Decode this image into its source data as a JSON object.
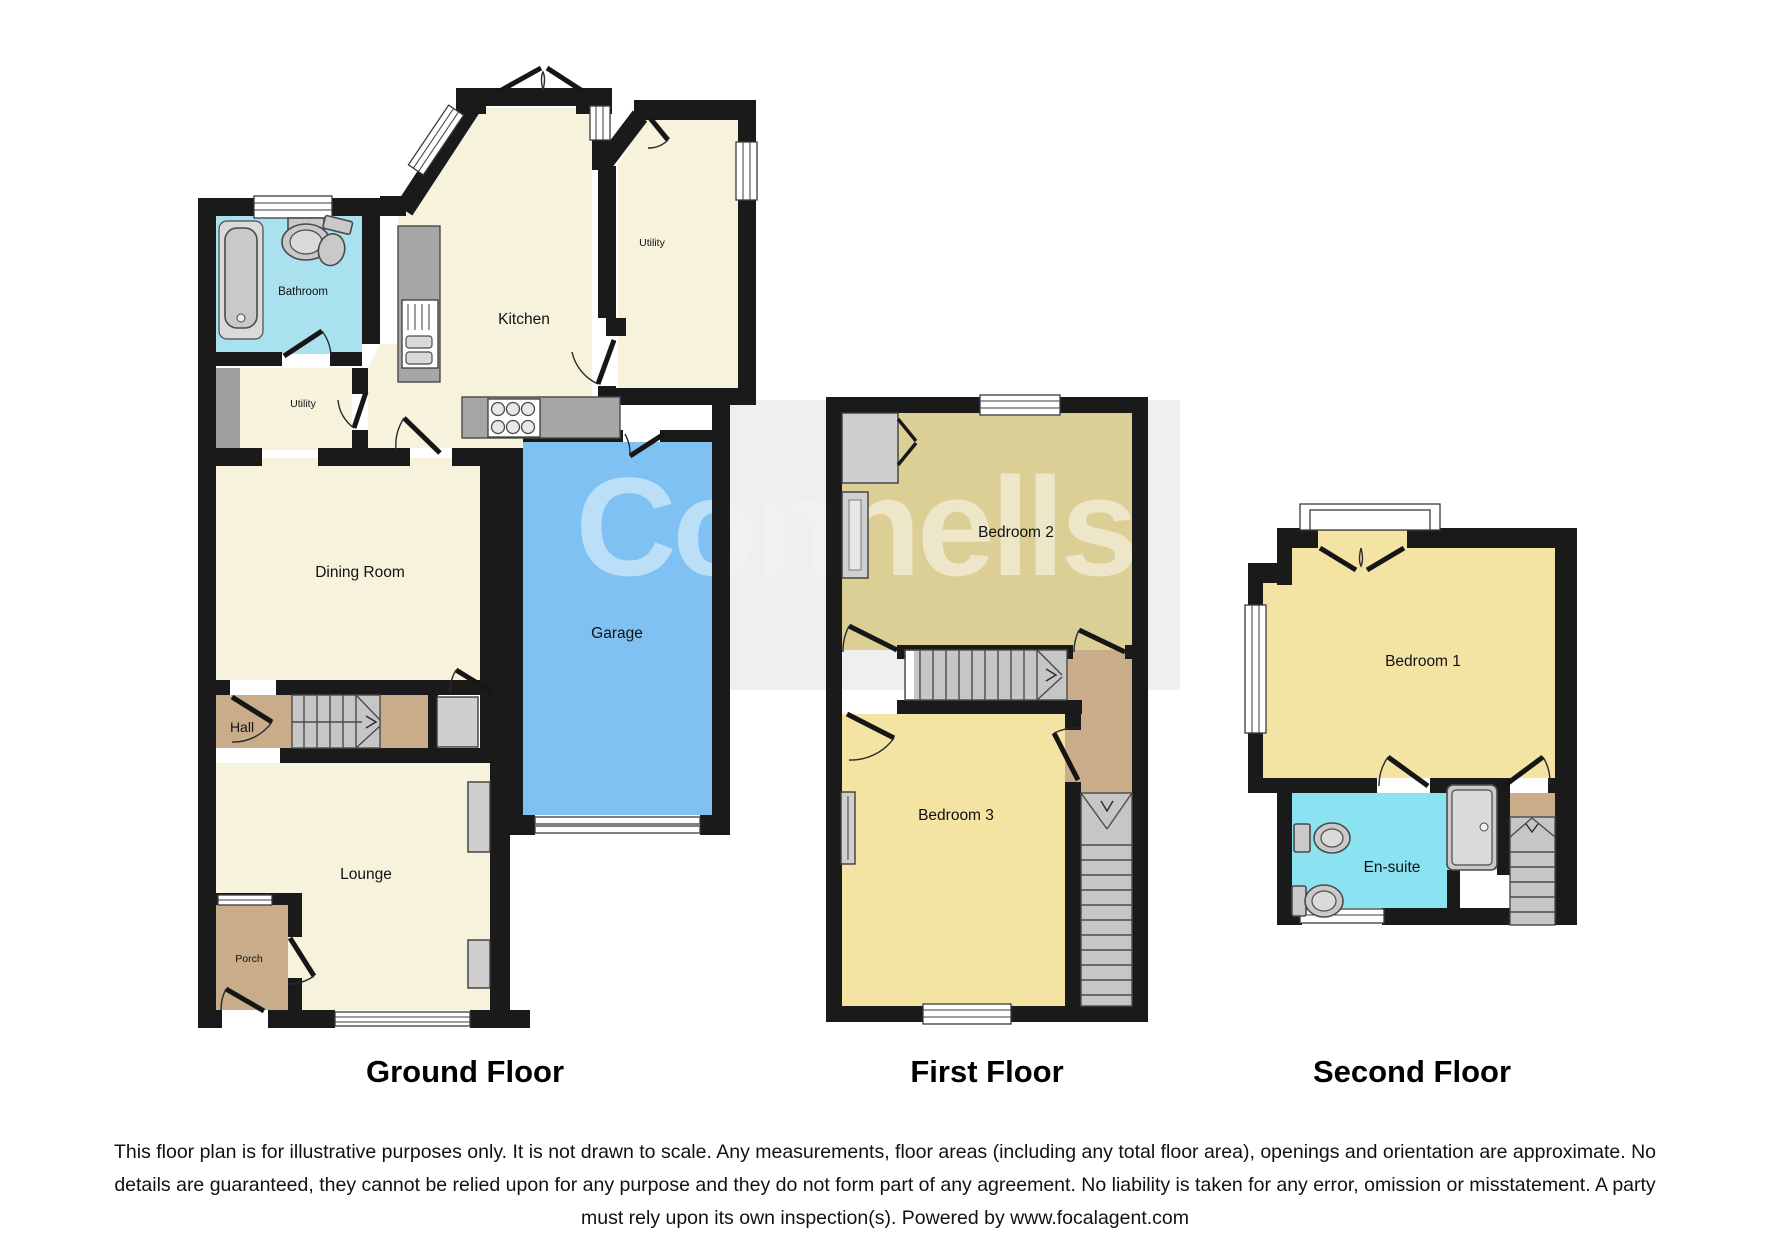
{
  "watermark": {
    "text": "Connells"
  },
  "floors": {
    "ground": {
      "title": "Ground Floor",
      "rooms": {
        "bathroom": "Bathroom",
        "utility_front": "Utility",
        "kitchen": "Kitchen",
        "utility_rear": "Utility",
        "dining": "Dining Room",
        "garage": "Garage",
        "hall": "Hall",
        "lounge": "Lounge",
        "porch": "Porch"
      }
    },
    "first": {
      "title": "First Floor",
      "rooms": {
        "bedroom2": "Bedroom 2",
        "bedroom3": "Bedroom 3"
      }
    },
    "second": {
      "title": "Second Floor",
      "rooms": {
        "bedroom1": "Bedroom 1",
        "ensuite": "En-suite"
      }
    }
  },
  "disclaimer": {
    "lines": [
      "This floor plan is for illustrative purposes only. It is not drawn to scale. Any measurements, floor areas (including any total floor area), openings and orientation are approximate. No",
      "details are guaranteed, they cannot be relied upon for any purpose and they do not form part of any agreement. No liability is taken for any error, omission or misstatement. A party",
      "must rely upon its own inspection(s). Powered by www.focalagent.com"
    ]
  },
  "colors": {
    "wall": "#1a1a1a",
    "cream": "#f7f2dc",
    "bathroom": "#a9e2ee",
    "ensuite": "#8be3f2",
    "garage": "#7fc1f2",
    "tan": "#c9ad8b",
    "bedroom2": "#dccf96",
    "yellow": "#f4e4a4",
    "stairs": "#c6c6c6",
    "counter": "#a6a6a6",
    "feature": "#cfcfcf",
    "band": "#efefef",
    "wm": "#e4e4e4"
  },
  "icons": {
    "bathtub": "bathtub-icon",
    "basin": "basin-icon",
    "toilet": "toilet-icon",
    "shower": "shower-icon",
    "hob": "hob-icon",
    "sink_unit": "sink-unit-icon",
    "stairs": "stairs-icon",
    "window": "window-icon",
    "door_arc": "door-arc-icon"
  }
}
